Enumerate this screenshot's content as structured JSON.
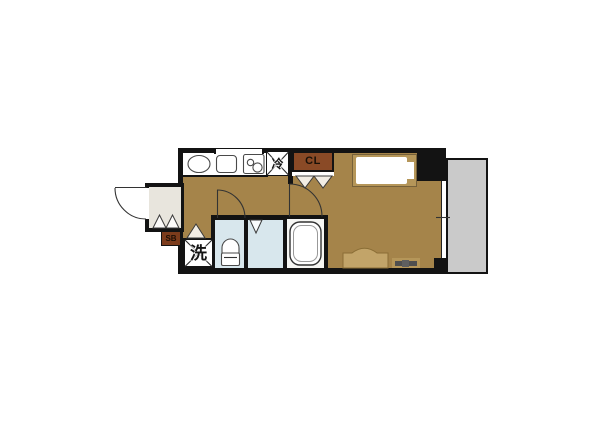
{
  "floorplan": {
    "labels": {
      "refrigerator": "冷",
      "closet": "CL",
      "shoe_box": "SB",
      "washing_machine": "洗"
    },
    "colors": {
      "wall": "#131313",
      "floor": "#a5844a",
      "wet": "#d8e7ed",
      "entrance": "#e8e5dd",
      "balcony": "#cacaca",
      "closet": "#8a4a26",
      "shoebox": "#7c3c1c",
      "bedframe": "#b59659",
      "furniture": "#c2a469",
      "tv": "#4f4f4f",
      "tub_bg": "#f6f6f3",
      "line": "#333333"
    }
  }
}
